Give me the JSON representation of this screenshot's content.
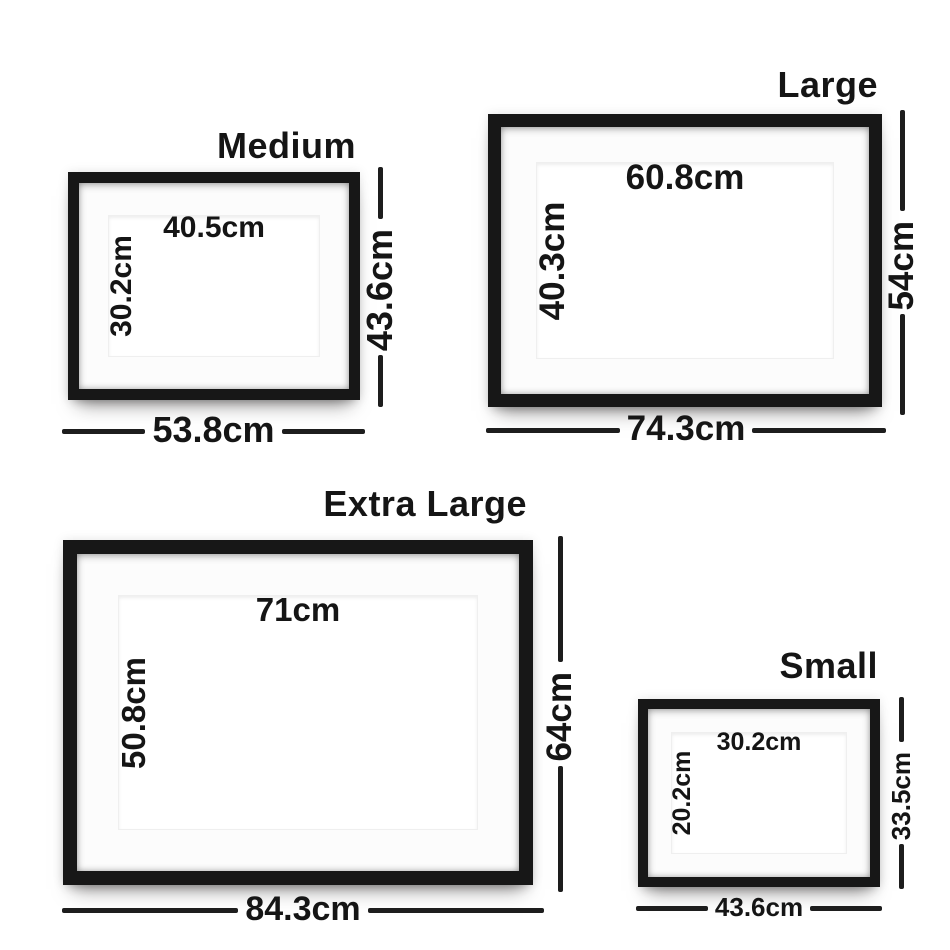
{
  "page": {
    "background_color": "#ffffff",
    "description_colors": {
      "frame_black": "#171717",
      "dimension_line": "#1d1d1d",
      "text": "#151515",
      "mat_white": "#fcfcfc",
      "opening_white": "#ffffff"
    }
  },
  "frames": [
    {
      "id": "medium",
      "name": "Medium",
      "inner_width": "40.5cm",
      "inner_height": "30.2cm",
      "outer_height": "43.6cm",
      "outer_width": "53.8cm"
    },
    {
      "id": "large",
      "name": "Large",
      "inner_width": "60.8cm",
      "inner_height": "40.3cm",
      "outer_height": "54cm",
      "outer_width": "74.3cm"
    },
    {
      "id": "extra-large",
      "name": "Extra Large",
      "inner_width": "71cm",
      "inner_height": "50.8cm",
      "outer_height": "64cm",
      "outer_width": "84.3cm"
    },
    {
      "id": "small",
      "name": "Small",
      "inner_width": "30.2cm",
      "inner_height": "20.2cm",
      "outer_height": "33.5cm",
      "outer_width": "43.6cm"
    }
  ]
}
